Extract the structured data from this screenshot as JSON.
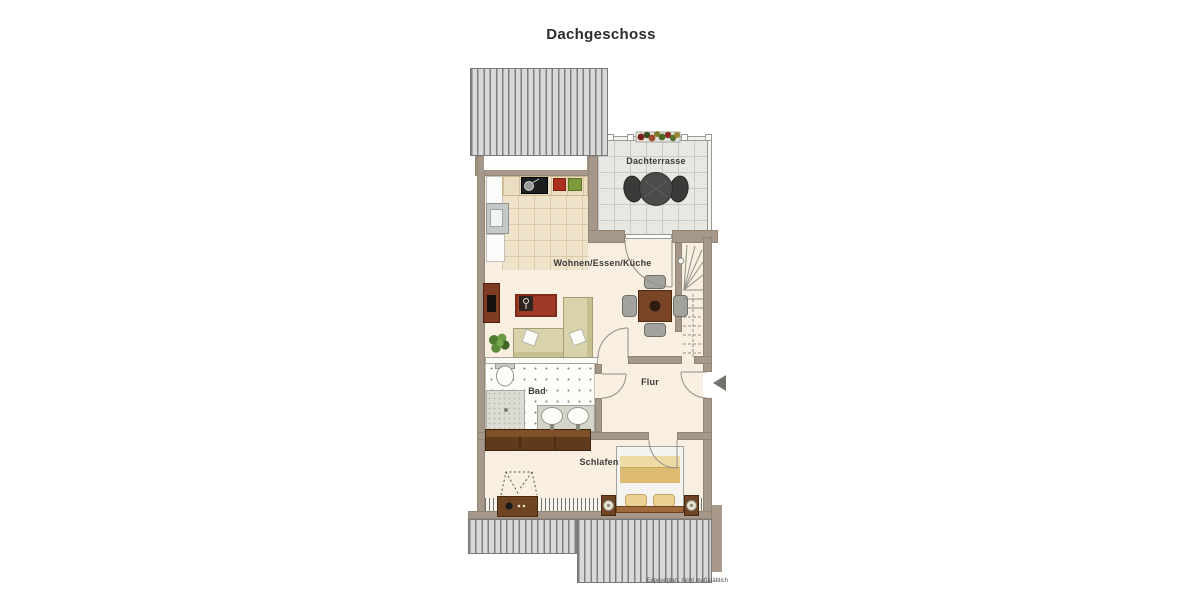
{
  "title": "Dachgeschoss",
  "rooms": {
    "terrace": {
      "label": "Dachterrasse"
    },
    "living": {
      "label": "Wohnen/Essen/Küche"
    },
    "hall": {
      "label": "Flur"
    },
    "bath": {
      "label": "Bad"
    },
    "bedroom": {
      "label": "Schlafen"
    }
  },
  "footer": {
    "note": "Exposéplan, nicht maßstäblich"
  },
  "colors": {
    "wall": "#a5988a",
    "floor": "#f8efe0",
    "kitchen_tile": "#efe2ca",
    "terrace_floor": "#e7e7e4",
    "roof_stripe": "#7f7f7f",
    "wood": "#6f4423",
    "sofa": "#d9d3ac",
    "rug": "#9c3a26",
    "label_text": "#3b3b38"
  }
}
